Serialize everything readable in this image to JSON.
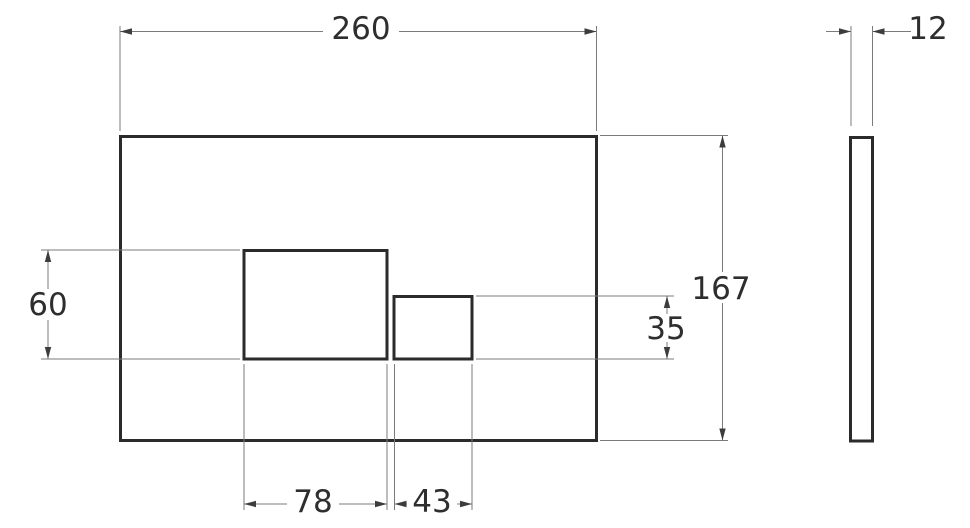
{
  "drawing": {
    "kind": "technical-dimension-drawing",
    "subject": "wall flush plate with two rectangular buttons, front view and side profile",
    "front_view": {
      "overall_width_label": "260",
      "overall_height_label": "167",
      "large_button": {
        "width_label": "78",
        "height_label": "60"
      },
      "small_button": {
        "width_label": "43",
        "height_label": "35"
      }
    },
    "side_view": {
      "thickness_label": "12"
    },
    "colors": {
      "background": "#ffffff",
      "outline": "#2b2b2b",
      "dimension_lines": "#7b7b7b",
      "arrowheads": "#3d3d3d",
      "text": "#2e2e2e"
    }
  }
}
